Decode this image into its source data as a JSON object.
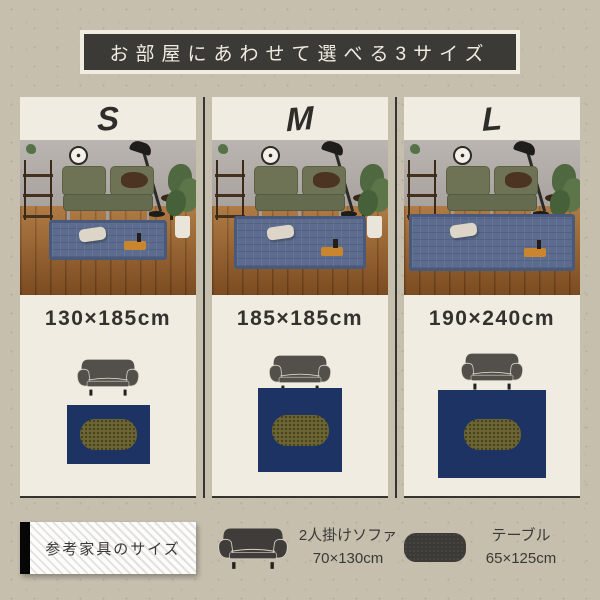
{
  "header": {
    "title": "お部屋にあわせて選べる3サイズ"
  },
  "columns": [
    {
      "size_label": "S",
      "dimension": "130×185cm",
      "photo_rug": {
        "w": 118,
        "h": 40,
        "top": 80
      },
      "diagram": {
        "rug_w": 83,
        "rug_h": 59,
        "gap": 8,
        "pad_top": 14
      }
    },
    {
      "size_label": "M",
      "dimension": "185×185cm",
      "photo_rug": {
        "w": 132,
        "h": 53,
        "top": 76
      },
      "diagram": {
        "rug_w": 84,
        "rug_h": 84,
        "gap": -5,
        "pad_top": 10
      }
    },
    {
      "size_label": "L",
      "dimension": "190×240cm",
      "photo_rug": {
        "w": 166,
        "h": 57,
        "top": 74
      },
      "diagram": {
        "rug_w": 108,
        "rug_h": 88,
        "gap": -1,
        "pad_top": 8
      }
    }
  ],
  "legend": {
    "label": "参考家具のサイズ",
    "sofa": {
      "name": "2人掛けソファ",
      "size": "70×130cm"
    },
    "table": {
      "name": "テーブル",
      "size": "65×125cm"
    }
  },
  "colors": {
    "bg": "#c6bfae",
    "panel": "#f0ece1",
    "ink": "#35342f",
    "banner_bg": "#3b3a37",
    "banner_text": "#efece0",
    "navy": "#1d3363",
    "olive": "#6b6433",
    "rug_photo": "#5c6c8e"
  }
}
